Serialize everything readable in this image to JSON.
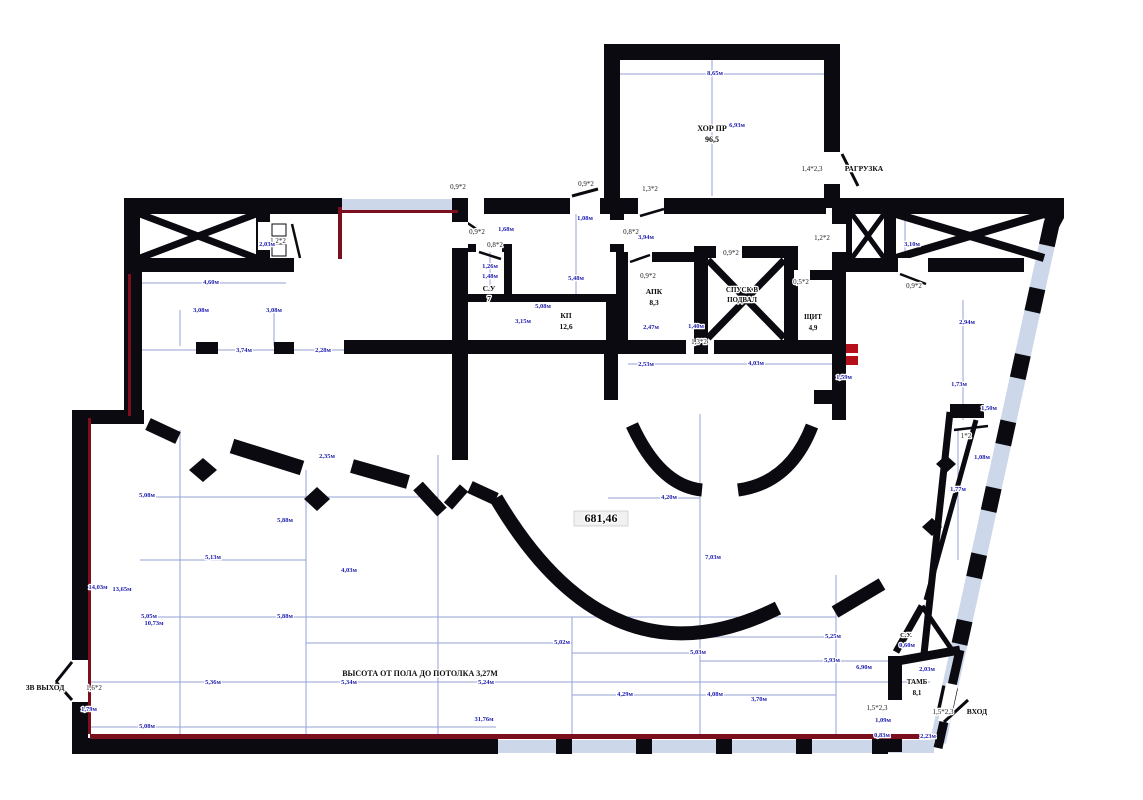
{
  "note": {
    "text": "ВЫСОТА ОТ ПОЛА ДО ПОТОЛКА 3,27М"
  },
  "colors": {
    "wall": "#0a0a10",
    "dimension_text": "#1c1cb0",
    "escape_line": "#7c0f1e",
    "hydrant_mark": "#b3101c",
    "glazing": "#ccd7ea",
    "background": "#ffffff"
  },
  "labels": {
    "rooms": [
      {
        "n": "room-label-hor-pr",
        "t": "ХОР ПР",
        "x": 712,
        "y": 131,
        "s": 8
      },
      {
        "n": "room-area-hor-pr",
        "t": "96,5",
        "x": 712,
        "y": 142,
        "s": 8
      },
      {
        "n": "room-label-razgruzka",
        "t": "РАГРУЗКА",
        "x": 864,
        "y": 171,
        "s": 7.5
      },
      {
        "n": "room-label-su7",
        "t": "С.У",
        "x": 489,
        "y": 291,
        "s": 7.5
      },
      {
        "n": "room-area-su7",
        "t": "7",
        "x": 489,
        "y": 301,
        "s": 7.5
      },
      {
        "n": "room-label-kp",
        "t": "КП",
        "x": 566,
        "y": 318,
        "s": 7.5
      },
      {
        "n": "room-area-kp",
        "t": "12,6",
        "x": 566,
        "y": 329,
        "s": 7.5
      },
      {
        "n": "room-label-apk",
        "t": "АПК",
        "x": 654,
        "y": 294,
        "s": 7.5
      },
      {
        "n": "room-area-apk",
        "t": "8,3",
        "x": 654,
        "y": 305,
        "s": 7.5
      },
      {
        "n": "room-label-spusk-1",
        "t": "СПУСК В",
        "x": 742,
        "y": 292,
        "s": 7
      },
      {
        "n": "room-label-spusk-2",
        "t": "ПОДВАЛ",
        "x": 742,
        "y": 302,
        "s": 7
      },
      {
        "n": "room-label-shchit",
        "t": "ЩИТ",
        "x": 813,
        "y": 319,
        "s": 7
      },
      {
        "n": "room-area-shchit",
        "t": "4,9",
        "x": 813,
        "y": 330,
        "s": 7
      },
      {
        "n": "hall-area-label",
        "t": "681,46",
        "x": 601,
        "y": 522,
        "s": 12
      },
      {
        "n": "room-label-su-small",
        "t": "С.У.",
        "x": 906,
        "y": 637,
        "s": 6.5
      },
      {
        "n": "room-label-tamb",
        "t": "ТАМБ",
        "x": 917,
        "y": 684,
        "s": 7
      },
      {
        "n": "room-area-tamb",
        "t": "8,1",
        "x": 917,
        "y": 695,
        "s": 7
      },
      {
        "n": "entrance-label",
        "t": "ВХОД",
        "x": 977,
        "y": 714,
        "s": 7.5
      },
      {
        "n": "exit-label",
        "t": "ЗВ ВЫХОД",
        "x": 45,
        "y": 690,
        "s": 7.5
      }
    ],
    "doors": [
      {
        "n": "door-size-left-shaft",
        "t": "1,2*2",
        "x": 278,
        "y": 243
      },
      {
        "n": "door-size-top-1",
        "t": "0,9*2",
        "x": 458,
        "y": 189
      },
      {
        "n": "door-size-top-2",
        "t": "0,9*2",
        "x": 586,
        "y": 186
      },
      {
        "n": "door-size-top-3",
        "t": "1,3*2",
        "x": 650,
        "y": 191
      },
      {
        "n": "door-size-corridor",
        "t": "0,8*2",
        "x": 631,
        "y": 234
      },
      {
        "n": "door-size-su-corr",
        "t": "0,9*2",
        "x": 477,
        "y": 234
      },
      {
        "n": "door-size-su7",
        "t": "0,8*2",
        "x": 495,
        "y": 247
      },
      {
        "n": "door-size-apk",
        "t": "0,9*2",
        "x": 648,
        "y": 278
      },
      {
        "n": "door-size-spusk",
        "t": "0,9*2",
        "x": 731,
        "y": 255
      },
      {
        "n": "door-size-shchit",
        "t": "0,5*2",
        "x": 801,
        "y": 284
      },
      {
        "n": "door-size-hall",
        "t": "1,3*2",
        "x": 699,
        "y": 344
      },
      {
        "n": "door-size-right-shaft",
        "t": "0,9*2",
        "x": 914,
        "y": 288
      },
      {
        "n": "door-size-right-wall",
        "t": "1,2*2",
        "x": 822,
        "y": 240
      },
      {
        "n": "door-size-wedge",
        "t": "1*2",
        "x": 966,
        "y": 438
      },
      {
        "n": "door-size-razgruzka",
        "t": "1,4*2,3",
        "x": 812,
        "y": 171
      },
      {
        "n": "door-size-tamb-left",
        "t": "1,5*2,3",
        "x": 877,
        "y": 710
      },
      {
        "n": "door-size-entrance",
        "t": "1,5*2,3",
        "x": 943,
        "y": 714
      },
      {
        "n": "door-size-exit",
        "t": "1,6*2",
        "x": 94,
        "y": 690
      }
    ],
    "dims": [
      {
        "t": "8,65м",
        "x": 715,
        "y": 75
      },
      {
        "t": "6,93м",
        "x": 737,
        "y": 127
      },
      {
        "t": "3,10м",
        "x": 912,
        "y": 246
      },
      {
        "t": "2,03м",
        "x": 267,
        "y": 246
      },
      {
        "t": "4,60м",
        "x": 211,
        "y": 284
      },
      {
        "t": "3,08м",
        "x": 201,
        "y": 312
      },
      {
        "t": "3,08м",
        "x": 274,
        "y": 312
      },
      {
        "t": "3,74м",
        "x": 244,
        "y": 352
      },
      {
        "t": "2,28м",
        "x": 323,
        "y": 352
      },
      {
        "t": "1,08м",
        "x": 585,
        "y": 220
      },
      {
        "t": "3,94м",
        "x": 646,
        "y": 239
      },
      {
        "t": "1,68м",
        "x": 506,
        "y": 231
      },
      {
        "t": "1,26м",
        "x": 490,
        "y": 268
      },
      {
        "t": "1,48м",
        "x": 490,
        "y": 278
      },
      {
        "t": "5,48м",
        "x": 576,
        "y": 280
      },
      {
        "t": "5,08м",
        "x": 543,
        "y": 308
      },
      {
        "t": "3,15м",
        "x": 523,
        "y": 323
      },
      {
        "t": "2,47м",
        "x": 651,
        "y": 329
      },
      {
        "t": "1,40м",
        "x": 696,
        "y": 328
      },
      {
        "t": "2,53м",
        "x": 646,
        "y": 366
      },
      {
        "t": "4,03м",
        "x": 756,
        "y": 365
      },
      {
        "t": "1,59м",
        "x": 844,
        "y": 379
      },
      {
        "t": "4,20м",
        "x": 669,
        "y": 499
      },
      {
        "t": "7,03м",
        "x": 713,
        "y": 559
      },
      {
        "t": "2,35м",
        "x": 327,
        "y": 458
      },
      {
        "t": "5,88м",
        "x": 285,
        "y": 522
      },
      {
        "t": "5,13м",
        "x": 213,
        "y": 559
      },
      {
        "t": "4,03м",
        "x": 349,
        "y": 572
      },
      {
        "t": "5,88м",
        "x": 285,
        "y": 618
      },
      {
        "t": "14,03м",
        "x": 98,
        "y": 589
      },
      {
        "t": "13,65м",
        "x": 122,
        "y": 591
      },
      {
        "t": "10,73м",
        "x": 154,
        "y": 625
      },
      {
        "t": "5,08м",
        "x": 147,
        "y": 497
      },
      {
        "t": "5,05м",
        "x": 149,
        "y": 618
      },
      {
        "t": "5,36м",
        "x": 213,
        "y": 684
      },
      {
        "t": "5,34м",
        "x": 349,
        "y": 684
      },
      {
        "t": "5,24м",
        "x": 486,
        "y": 684
      },
      {
        "t": "31,76м",
        "x": 484,
        "y": 721
      },
      {
        "t": "5,08м",
        "x": 147,
        "y": 728
      },
      {
        "t": "1,79м",
        "x": 89,
        "y": 711
      },
      {
        "t": "5,02м",
        "x": 562,
        "y": 644
      },
      {
        "t": "5,03м",
        "x": 698,
        "y": 654
      },
      {
        "t": "5,25м",
        "x": 833,
        "y": 638
      },
      {
        "t": "5,93м",
        "x": 832,
        "y": 662
      },
      {
        "t": "6,90м",
        "x": 864,
        "y": 669
      },
      {
        "t": "4,29м",
        "x": 625,
        "y": 696
      },
      {
        "t": "4,08м",
        "x": 715,
        "y": 696
      },
      {
        "t": "3,70м",
        "x": 759,
        "y": 701
      },
      {
        "t": "2,03м",
        "x": 927,
        "y": 671
      },
      {
        "t": "1,09м",
        "x": 883,
        "y": 722
      },
      {
        "t": "0,83м",
        "x": 882,
        "y": 737
      },
      {
        "t": "2,23м",
        "x": 928,
        "y": 738
      },
      {
        "t": "0,60м",
        "x": 907,
        "y": 647
      },
      {
        "t": "2,94м",
        "x": 967,
        "y": 324
      },
      {
        "t": "1,73м",
        "x": 959,
        "y": 386
      },
      {
        "t": "1,50м",
        "x": 989,
        "y": 410
      },
      {
        "t": "1,08м",
        "x": 982,
        "y": 459
      },
      {
        "t": "1,77м",
        "x": 958,
        "y": 491
      }
    ]
  }
}
